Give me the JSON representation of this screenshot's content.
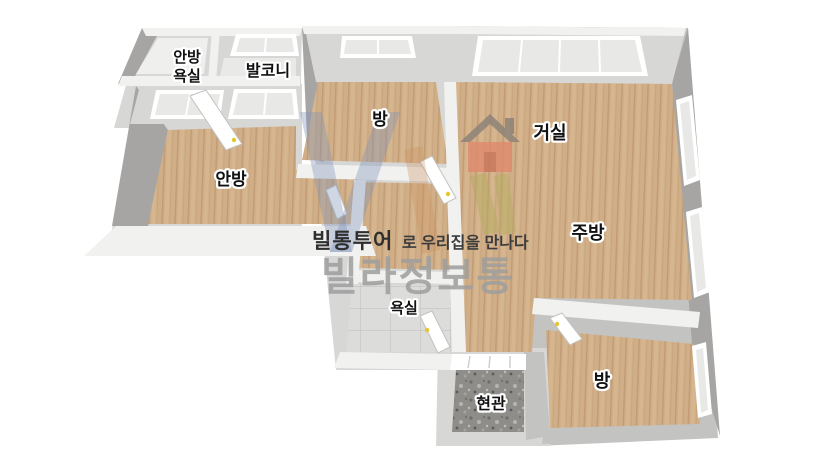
{
  "title": "villa-floorplan",
  "watermark": {
    "tagline_brand": "빌통투어",
    "tagline_rest": "로 우리집을 만나다",
    "brand": "빌라정보통"
  },
  "rooms": {
    "master_bath_line1": "안방",
    "master_bath_line2": "욕실",
    "balcony": "발코니",
    "room_top": "방",
    "living_room": "거실",
    "master_bedroom": "안방",
    "kitchen": "주방",
    "bathroom": "욕실",
    "room_bottom": "방",
    "entrance": "현관"
  },
  "colors": {
    "background": "#ffffff",
    "wood_floor": "#d0ae87",
    "wood_plank_line": "#c19b74",
    "wall_white": "#f1f1f0",
    "wall_light": "#d7d7d6",
    "wall_mid": "#c3c3c2",
    "wall_dark": "#a6a5a3",
    "tile_floor": "#dcdcda",
    "granite_floor": "#8f8d8a",
    "window_glass": "#e8e8e7",
    "door_handle": "#e6c62f",
    "label_text": "#111111",
    "label_outline": "#ffffff",
    "brand_gray": "#9e9e9e",
    "tagline_dark": "#2e2e2e",
    "logo_house_body": "#e08a6d",
    "logo_house_roof": "#8a8178",
    "logo_stripe_olive": "#b3ab5e",
    "logo_letter_blue": "#8093b8"
  }
}
